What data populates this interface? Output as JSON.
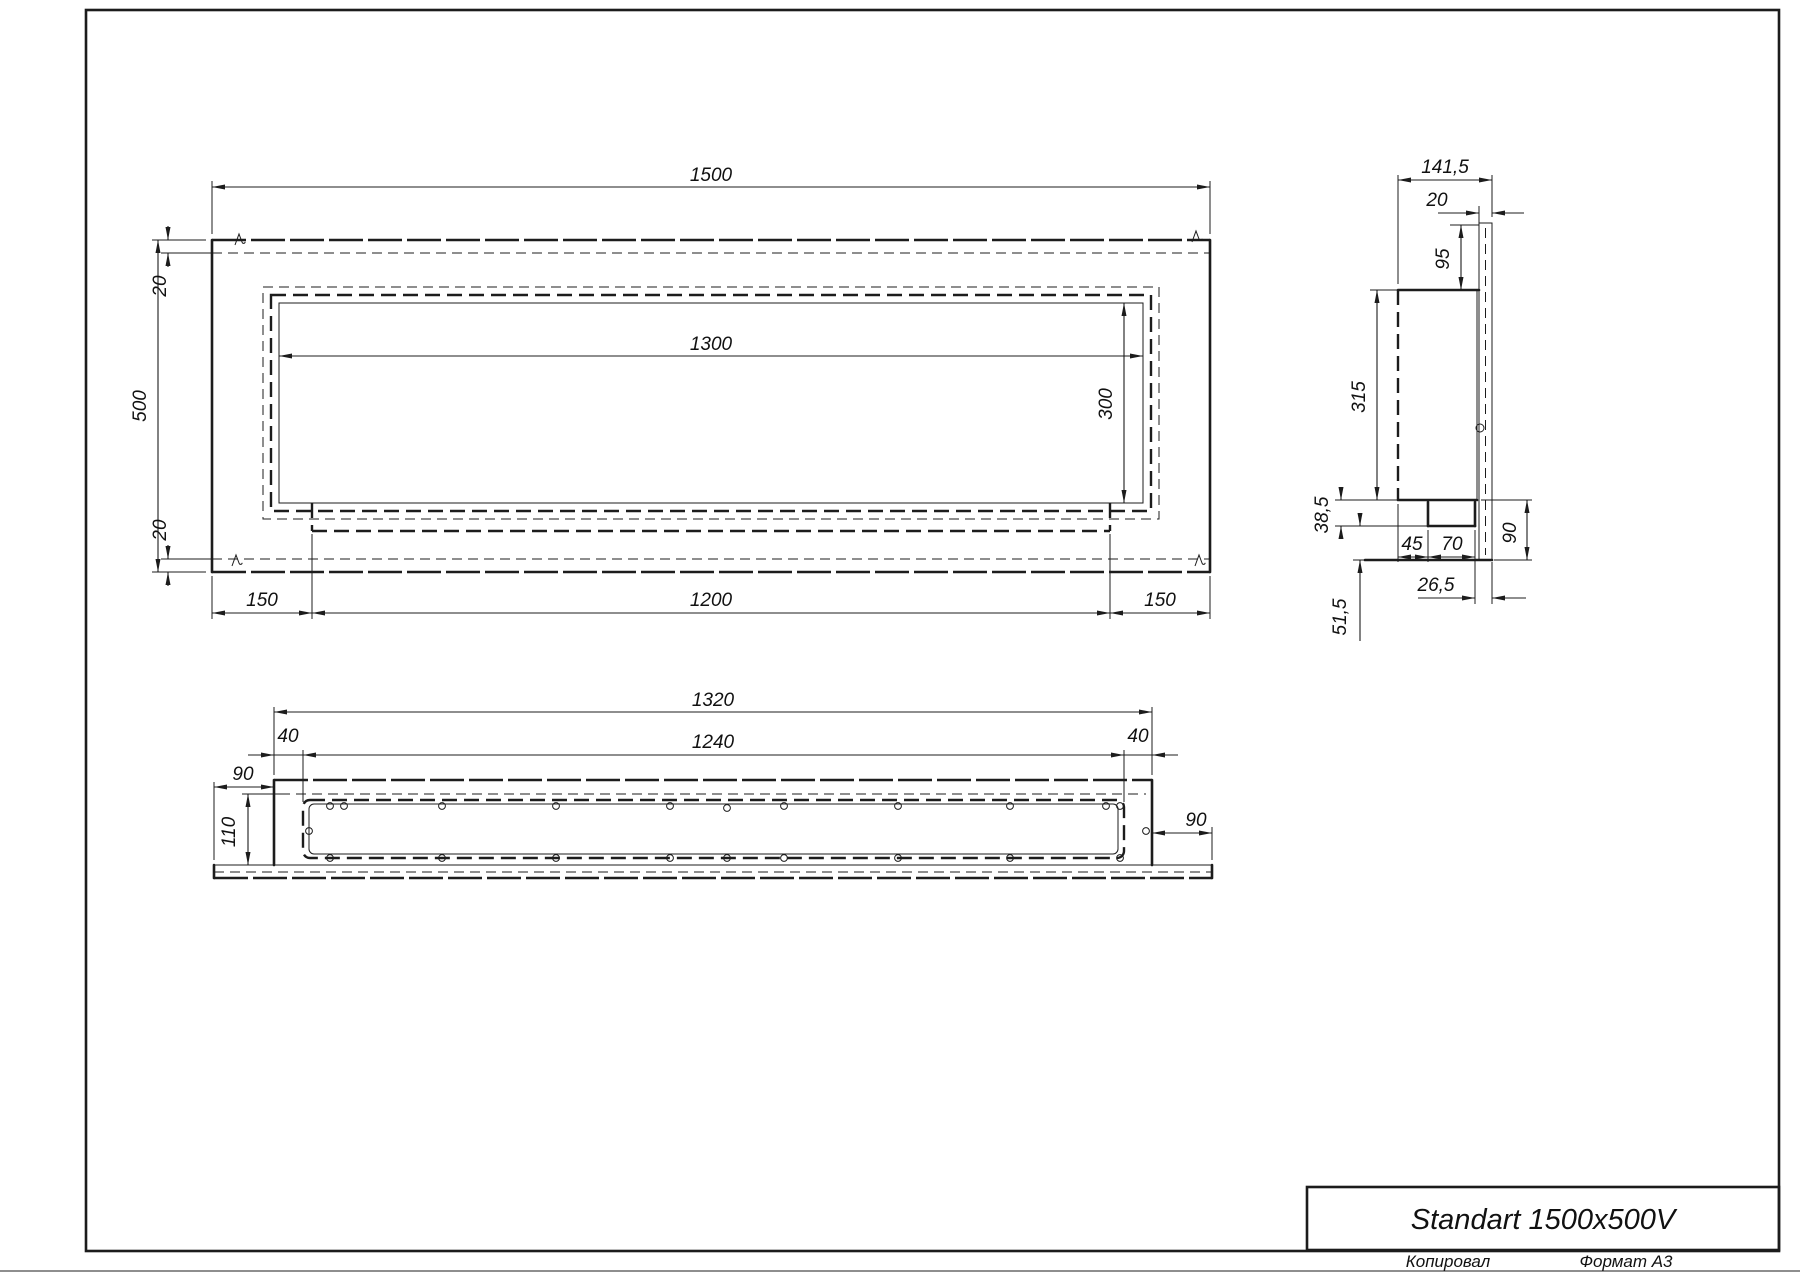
{
  "drawing": {
    "title": "Standart 1500x500V",
    "footer": {
      "copied": "Копировал",
      "format": "Формат А3"
    }
  },
  "front_view": {
    "dims": {
      "width": "1500",
      "height": "500",
      "top_inset": "20",
      "bottom_inset": "20",
      "opening_width": "1300",
      "opening_height": "300",
      "left_margin": "150",
      "tray_width": "1200",
      "right_margin": "150"
    }
  },
  "side_view": {
    "dims": {
      "depth": "141,5",
      "flange_width": "20",
      "top_offset": "95",
      "body_height": "315",
      "burner_depth": "38,5",
      "front_gap": "45",
      "burner_width": "70",
      "base_height": "90",
      "flange_gap": "26,5",
      "base_offset": "51,5"
    }
  },
  "bottom_view": {
    "dims": {
      "body_width": "1320",
      "opening_width": "1240",
      "left_inset": "40",
      "right_inset": "40",
      "left_overhang": "90",
      "depth": "110",
      "right_overhang": "90"
    }
  }
}
